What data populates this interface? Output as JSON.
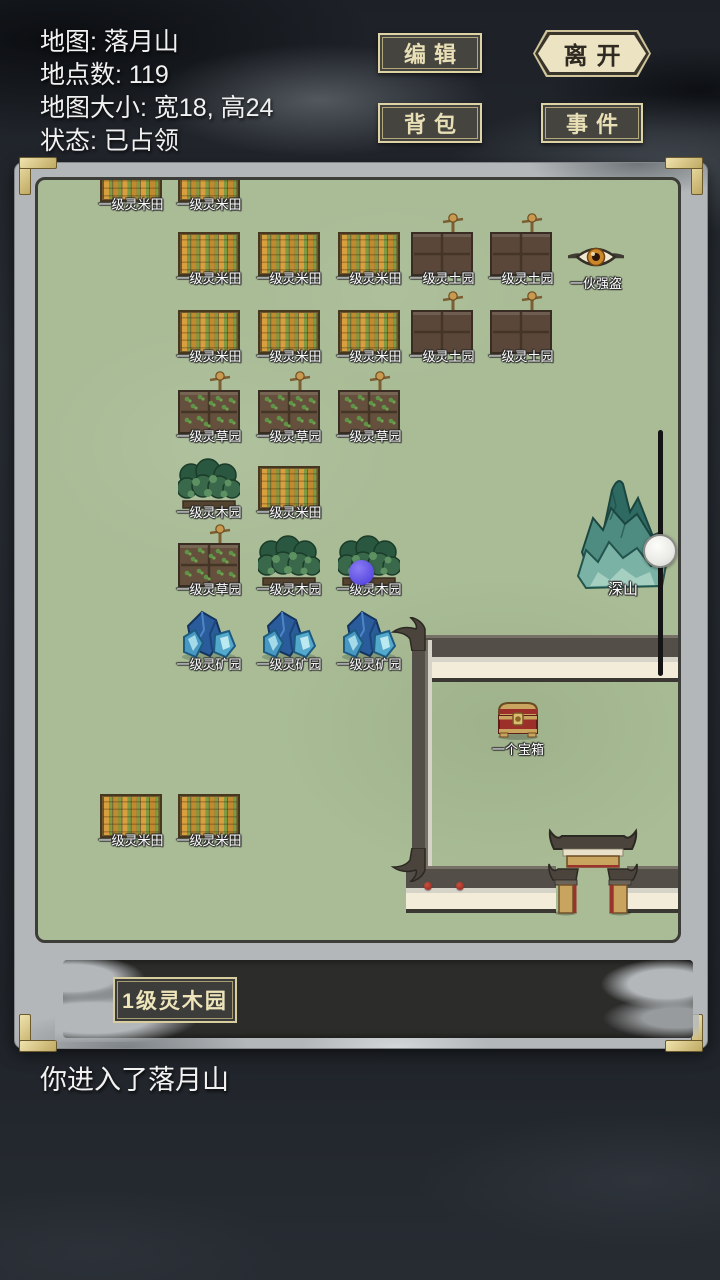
{
  "info_panel": {
    "map_name": "地图: 落月山",
    "location_count": "地点数: 119",
    "map_size": "地图大小: 宽18, 高24",
    "status": "状态: 已占领"
  },
  "toolbar": {
    "edit": "编辑",
    "leave": "离开",
    "backpack": "背包",
    "event": "事件"
  },
  "map": {
    "tiles": [
      {
        "type": "rice",
        "x": 62,
        "b": 22,
        "label": "一级灵米田"
      },
      {
        "type": "rice",
        "x": 140,
        "b": 22,
        "label": "一级灵米田"
      },
      {
        "type": "rice",
        "x": 140,
        "b": 96,
        "label": "一级灵米田"
      },
      {
        "type": "rice",
        "x": 220,
        "b": 96,
        "label": "一级灵米田"
      },
      {
        "type": "rice",
        "x": 300,
        "b": 96,
        "label": "一级灵米田"
      },
      {
        "type": "soil",
        "x": 373,
        "b": 96,
        "label": "一级灵土园"
      },
      {
        "type": "soil",
        "x": 452,
        "b": 96,
        "label": "一级灵土园"
      },
      {
        "type": "bandit",
        "x": 530,
        "b": 92,
        "label": "一伙强盗"
      },
      {
        "type": "rice",
        "x": 140,
        "b": 174,
        "label": "一级灵米田"
      },
      {
        "type": "rice",
        "x": 220,
        "b": 174,
        "label": "一级灵米田"
      },
      {
        "type": "rice",
        "x": 300,
        "b": 174,
        "label": "一级灵米田"
      },
      {
        "type": "soil",
        "x": 373,
        "b": 174,
        "label": "一级灵土园"
      },
      {
        "type": "soil",
        "x": 452,
        "b": 174,
        "label": "一级灵土园"
      },
      {
        "type": "grass",
        "x": 140,
        "b": 254,
        "label": "一级灵草园"
      },
      {
        "type": "grass",
        "x": 220,
        "b": 254,
        "label": "一级灵草园"
      },
      {
        "type": "grass",
        "x": 300,
        "b": 254,
        "label": "一级灵草园"
      },
      {
        "type": "wood",
        "x": 140,
        "b": 330,
        "label": "一级灵木园"
      },
      {
        "type": "rice",
        "x": 220,
        "b": 330,
        "label": "一级灵米田"
      },
      {
        "type": "grass",
        "x": 140,
        "b": 407,
        "label": "一级灵草园"
      },
      {
        "type": "wood",
        "x": 220,
        "b": 407,
        "label": "一级灵木园"
      },
      {
        "type": "wood",
        "x": 300,
        "b": 407,
        "label": "一级灵木园"
      },
      {
        "type": "mine",
        "x": 140,
        "b": 482,
        "label": "一级灵矿园"
      },
      {
        "type": "mine",
        "x": 220,
        "b": 482,
        "label": "一级灵矿园"
      },
      {
        "type": "mine",
        "x": 300,
        "b": 482,
        "label": "一级灵矿园"
      },
      {
        "type": "mountain",
        "x": 538,
        "b": 412,
        "label": "深山"
      },
      {
        "type": "chest",
        "x": 456,
        "b": 560,
        "label": "一个宝箱"
      },
      {
        "type": "rice",
        "x": 62,
        "b": 658,
        "label": "一级灵米田"
      },
      {
        "type": "rice",
        "x": 140,
        "b": 658,
        "label": "一级灵米田"
      }
    ],
    "player_marker": {
      "x": 323,
      "y": 392
    }
  },
  "footer": {
    "selected_tile": "1级灵木园",
    "log_message": "你进入了落月山"
  },
  "palette": {
    "map_bg": "#a9bc96",
    "frame": "#b3b7ba",
    "gold": "#d9c98e",
    "player_marker": "#6a5ce8",
    "wall_cream": "#f2ecd8",
    "wall_dark": "#534e47",
    "button_text": "#e9dfb6",
    "leave_bg": "#ece3c2"
  }
}
